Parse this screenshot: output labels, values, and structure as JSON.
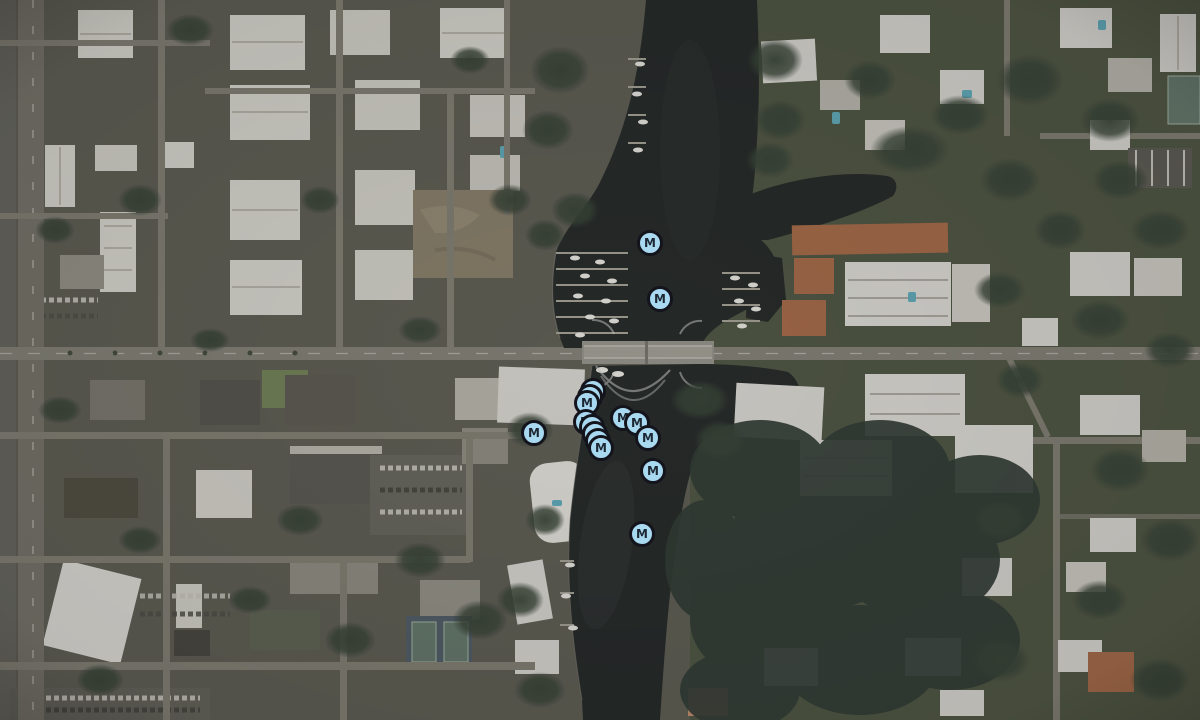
{
  "map": {
    "view": "satellite",
    "water_color": "#191e1d",
    "urban_land_color": "#56554c",
    "vegetation_color": "#464e3a",
    "road_color": "#7d7a6f"
  },
  "markers": {
    "symbol": "M",
    "fill": "#a8d9f0",
    "border": "#14141d",
    "label_color": "#1d2733",
    "items": [
      {
        "x": 650,
        "y": 243,
        "label": "M",
        "stack": 1
      },
      {
        "x": 660,
        "y": 299,
        "label": "M",
        "stack": 1
      },
      {
        "x": 587,
        "y": 403,
        "label": "M",
        "stack": 3,
        "stack_dx": 3,
        "stack_dy": -6
      },
      {
        "x": 586,
        "y": 422,
        "label": "M",
        "stack": 1
      },
      {
        "x": 534,
        "y": 433,
        "label": "M",
        "stack": 1
      },
      {
        "x": 601,
        "y": 448,
        "label": "M",
        "stack": 4,
        "stack_dx": -3,
        "stack_dy": -7
      },
      {
        "x": 623,
        "y": 418,
        "label": "M",
        "stack": 1
      },
      {
        "x": 637,
        "y": 423,
        "label": "M",
        "stack": 1
      },
      {
        "x": 648,
        "y": 438,
        "label": "M",
        "stack": 1
      },
      {
        "x": 653,
        "y": 471,
        "label": "M",
        "stack": 1
      },
      {
        "x": 642,
        "y": 534,
        "label": "M",
        "stack": 1
      }
    ]
  }
}
